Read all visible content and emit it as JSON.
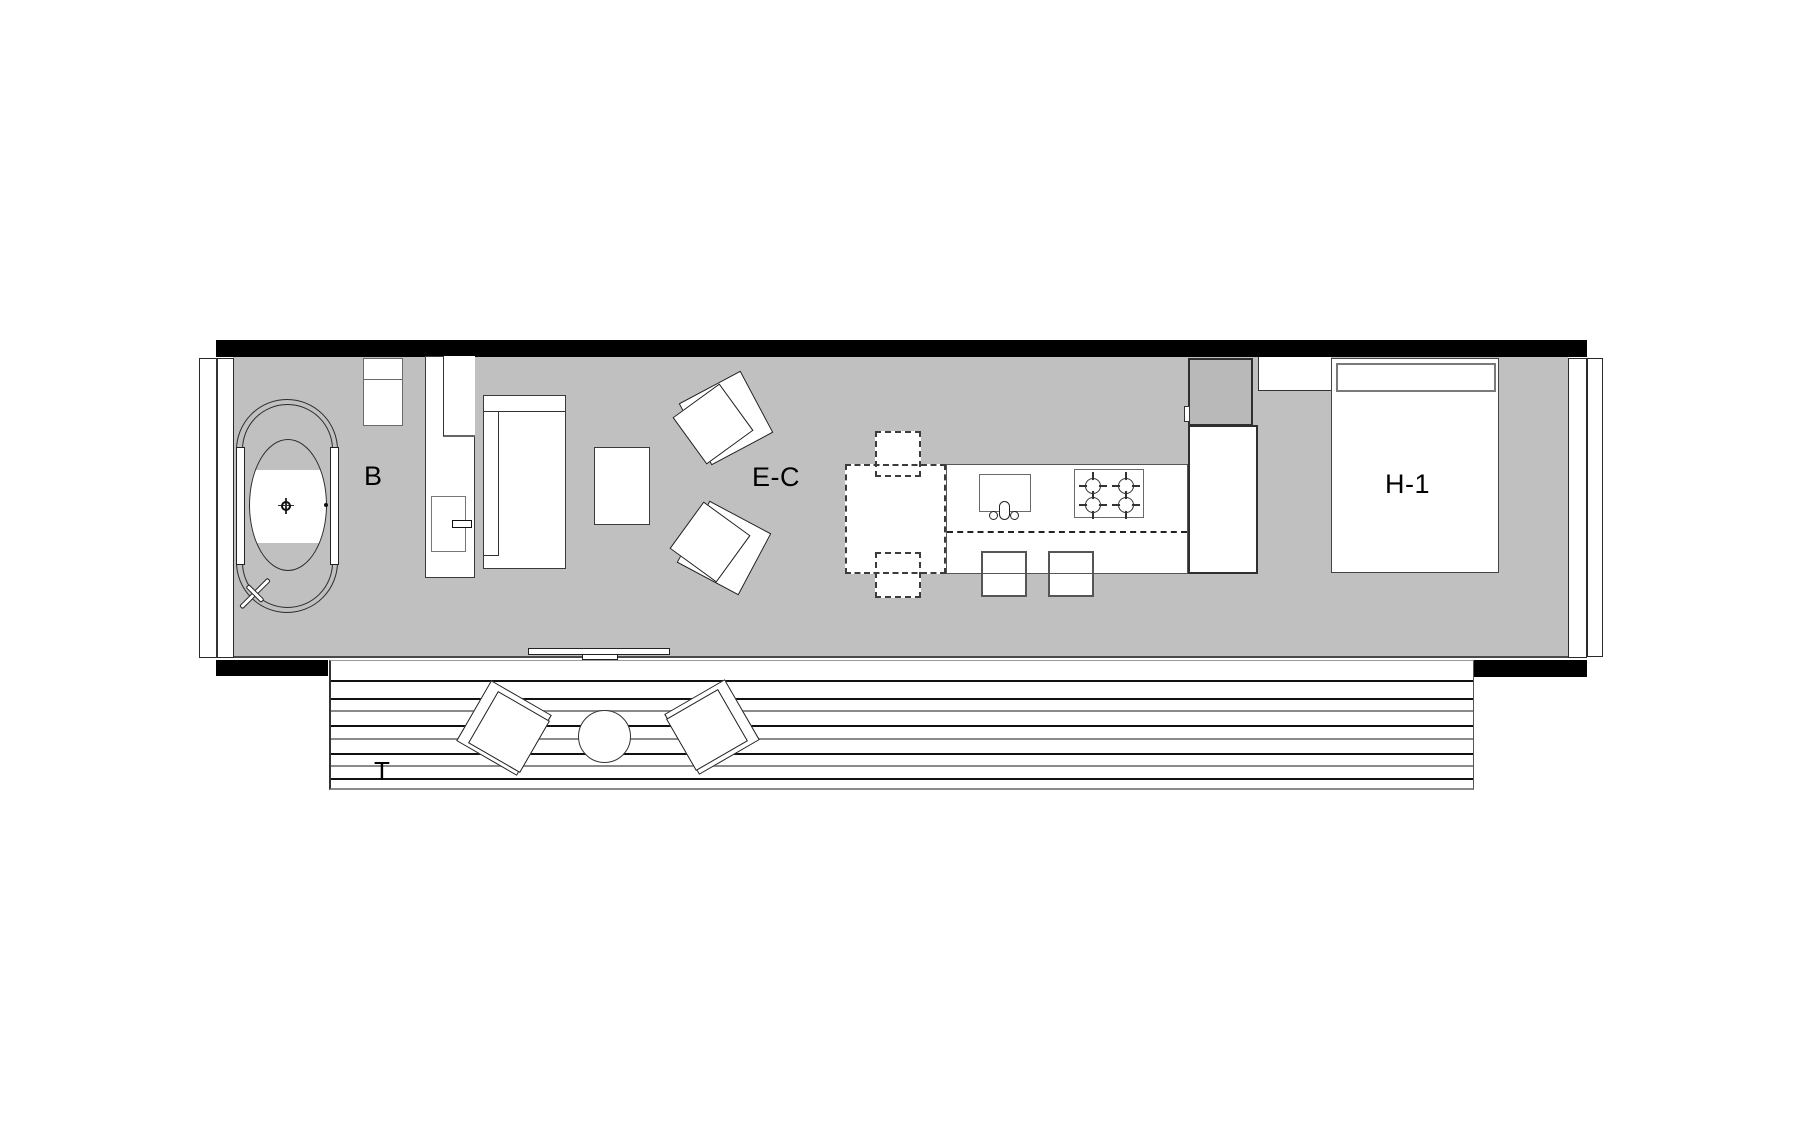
{
  "title": "Narrow module floor plan",
  "labels": {
    "bathroom": "B",
    "living_dining": "E-C",
    "bedroom": "H-1",
    "terrace": "T"
  },
  "colors": {
    "floor_gray": "#c0c0c0",
    "wall_black": "#000000",
    "tall_unit_gray": "#b9b9b9",
    "line_dark": "#333333",
    "line_gray": "#8a8a8a",
    "paper_white": "#ffffff"
  },
  "legend": {
    "bathtub": "oval freestanding tub with drain",
    "kitchen": "island with sink, 4-burner cooktop, 2 stools, dashed dining table with 2 dashed chairs",
    "terrace": "wood deck with 2 lounge chairs and round table"
  }
}
